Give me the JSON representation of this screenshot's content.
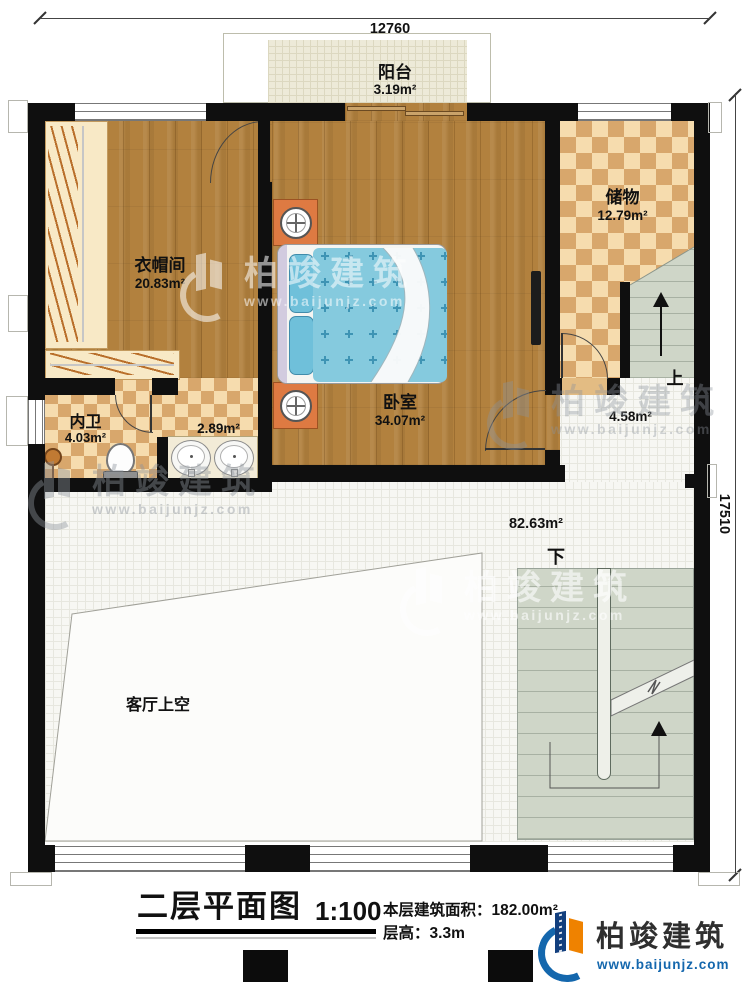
{
  "dimensions": {
    "top_width": "12760",
    "right_height": "17510"
  },
  "rooms": {
    "balcony": {
      "name": "阳台",
      "area": "3.19m²"
    },
    "cloakroom": {
      "name": "衣帽间",
      "area": "20.83m²"
    },
    "bedroom": {
      "name": "卧室",
      "area": "34.07m²"
    },
    "storage": {
      "name": "储物",
      "area": "12.79m²"
    },
    "bathroom": {
      "name": "内卫",
      "area": "4.03m²"
    },
    "vanity": {
      "area": "2.89m²"
    },
    "upper_stair_hall": {
      "area": "4.58m²"
    },
    "hall": {
      "area": "82.63m²"
    },
    "living_room_void": {
      "name": "客厅上空"
    }
  },
  "stairs": {
    "up_label": "上",
    "down_label": "下"
  },
  "title_block": {
    "title": "二层平面图",
    "scale": "1:100",
    "area_label": "本层建筑面积：",
    "area_value": "182.00m²",
    "floor_height_label": "层高：",
    "floor_height_value": "3.3m"
  },
  "branding": {
    "company": "柏竣建筑",
    "website": "www.baijunjz.com"
  },
  "colors": {
    "wall": "#0f0f0f",
    "wood_floor": "#b2813e",
    "checker_light": "#f6dcae",
    "checker_dark": "#d8a76c",
    "bed_blue": "#85cade",
    "stair_green": "#cfd6c8",
    "logo_blue": "#1467ad",
    "logo_orange": "#ef8200"
  }
}
